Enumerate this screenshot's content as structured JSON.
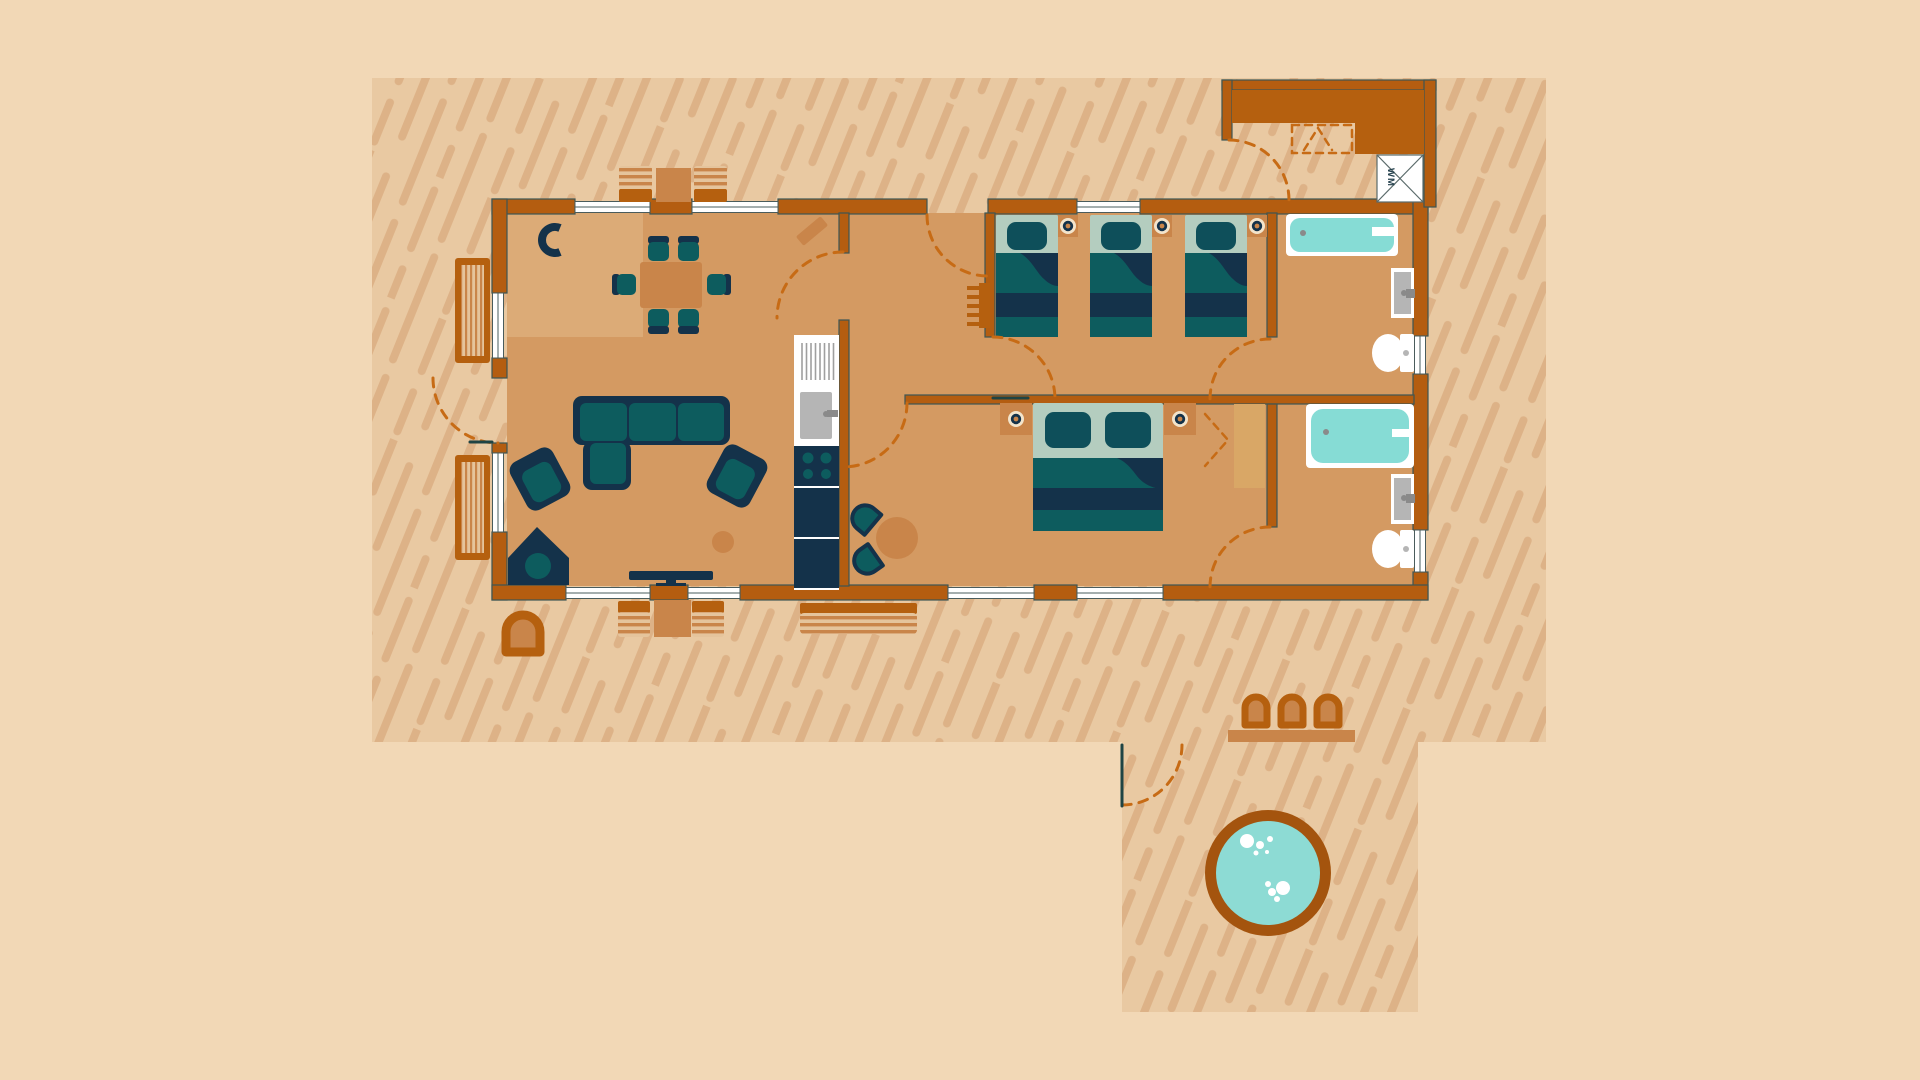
{
  "labels": {
    "washing_machine": "WM"
  },
  "colors": {
    "pageBg": "#f2d8b6",
    "ground": "#e9c9a2",
    "groundStripe": "#ddb287",
    "floor": "#d49a62",
    "rug": "#dcab77",
    "wall": "#b45d10",
    "wallLine": "#3d5654",
    "woodDark": "#b5600f",
    "woodMid": "#c9854a",
    "woodLight": "#e5c49c",
    "wardrobe": "#d9a766",
    "navy": "#14324a",
    "teal": "#0d5c5e",
    "pillow": "#0e4f5a",
    "sage": "#b4cdbf",
    "aqua": "#86dcd5",
    "white": "#ffffff",
    "grayLight": "#b5b5b5",
    "grayMid": "#8a8a8a",
    "cream": "#f3e4cb",
    "dashed": "#c76b15",
    "gateLine": "#1f4444",
    "tubRim": "#a4540e",
    "tubWater": "#8ddbd4"
  },
  "scene": {
    "type": "lodge-floor-plan-illustration",
    "areas": [
      "living-dining-area",
      "kitchen-strip",
      "hallway",
      "triple-bedroom",
      "double-bedroom",
      "bathroom-with-bath",
      "bathroom-with-shower",
      "utility-porch",
      "outdoor-deck",
      "hot-tub-area"
    ]
  }
}
